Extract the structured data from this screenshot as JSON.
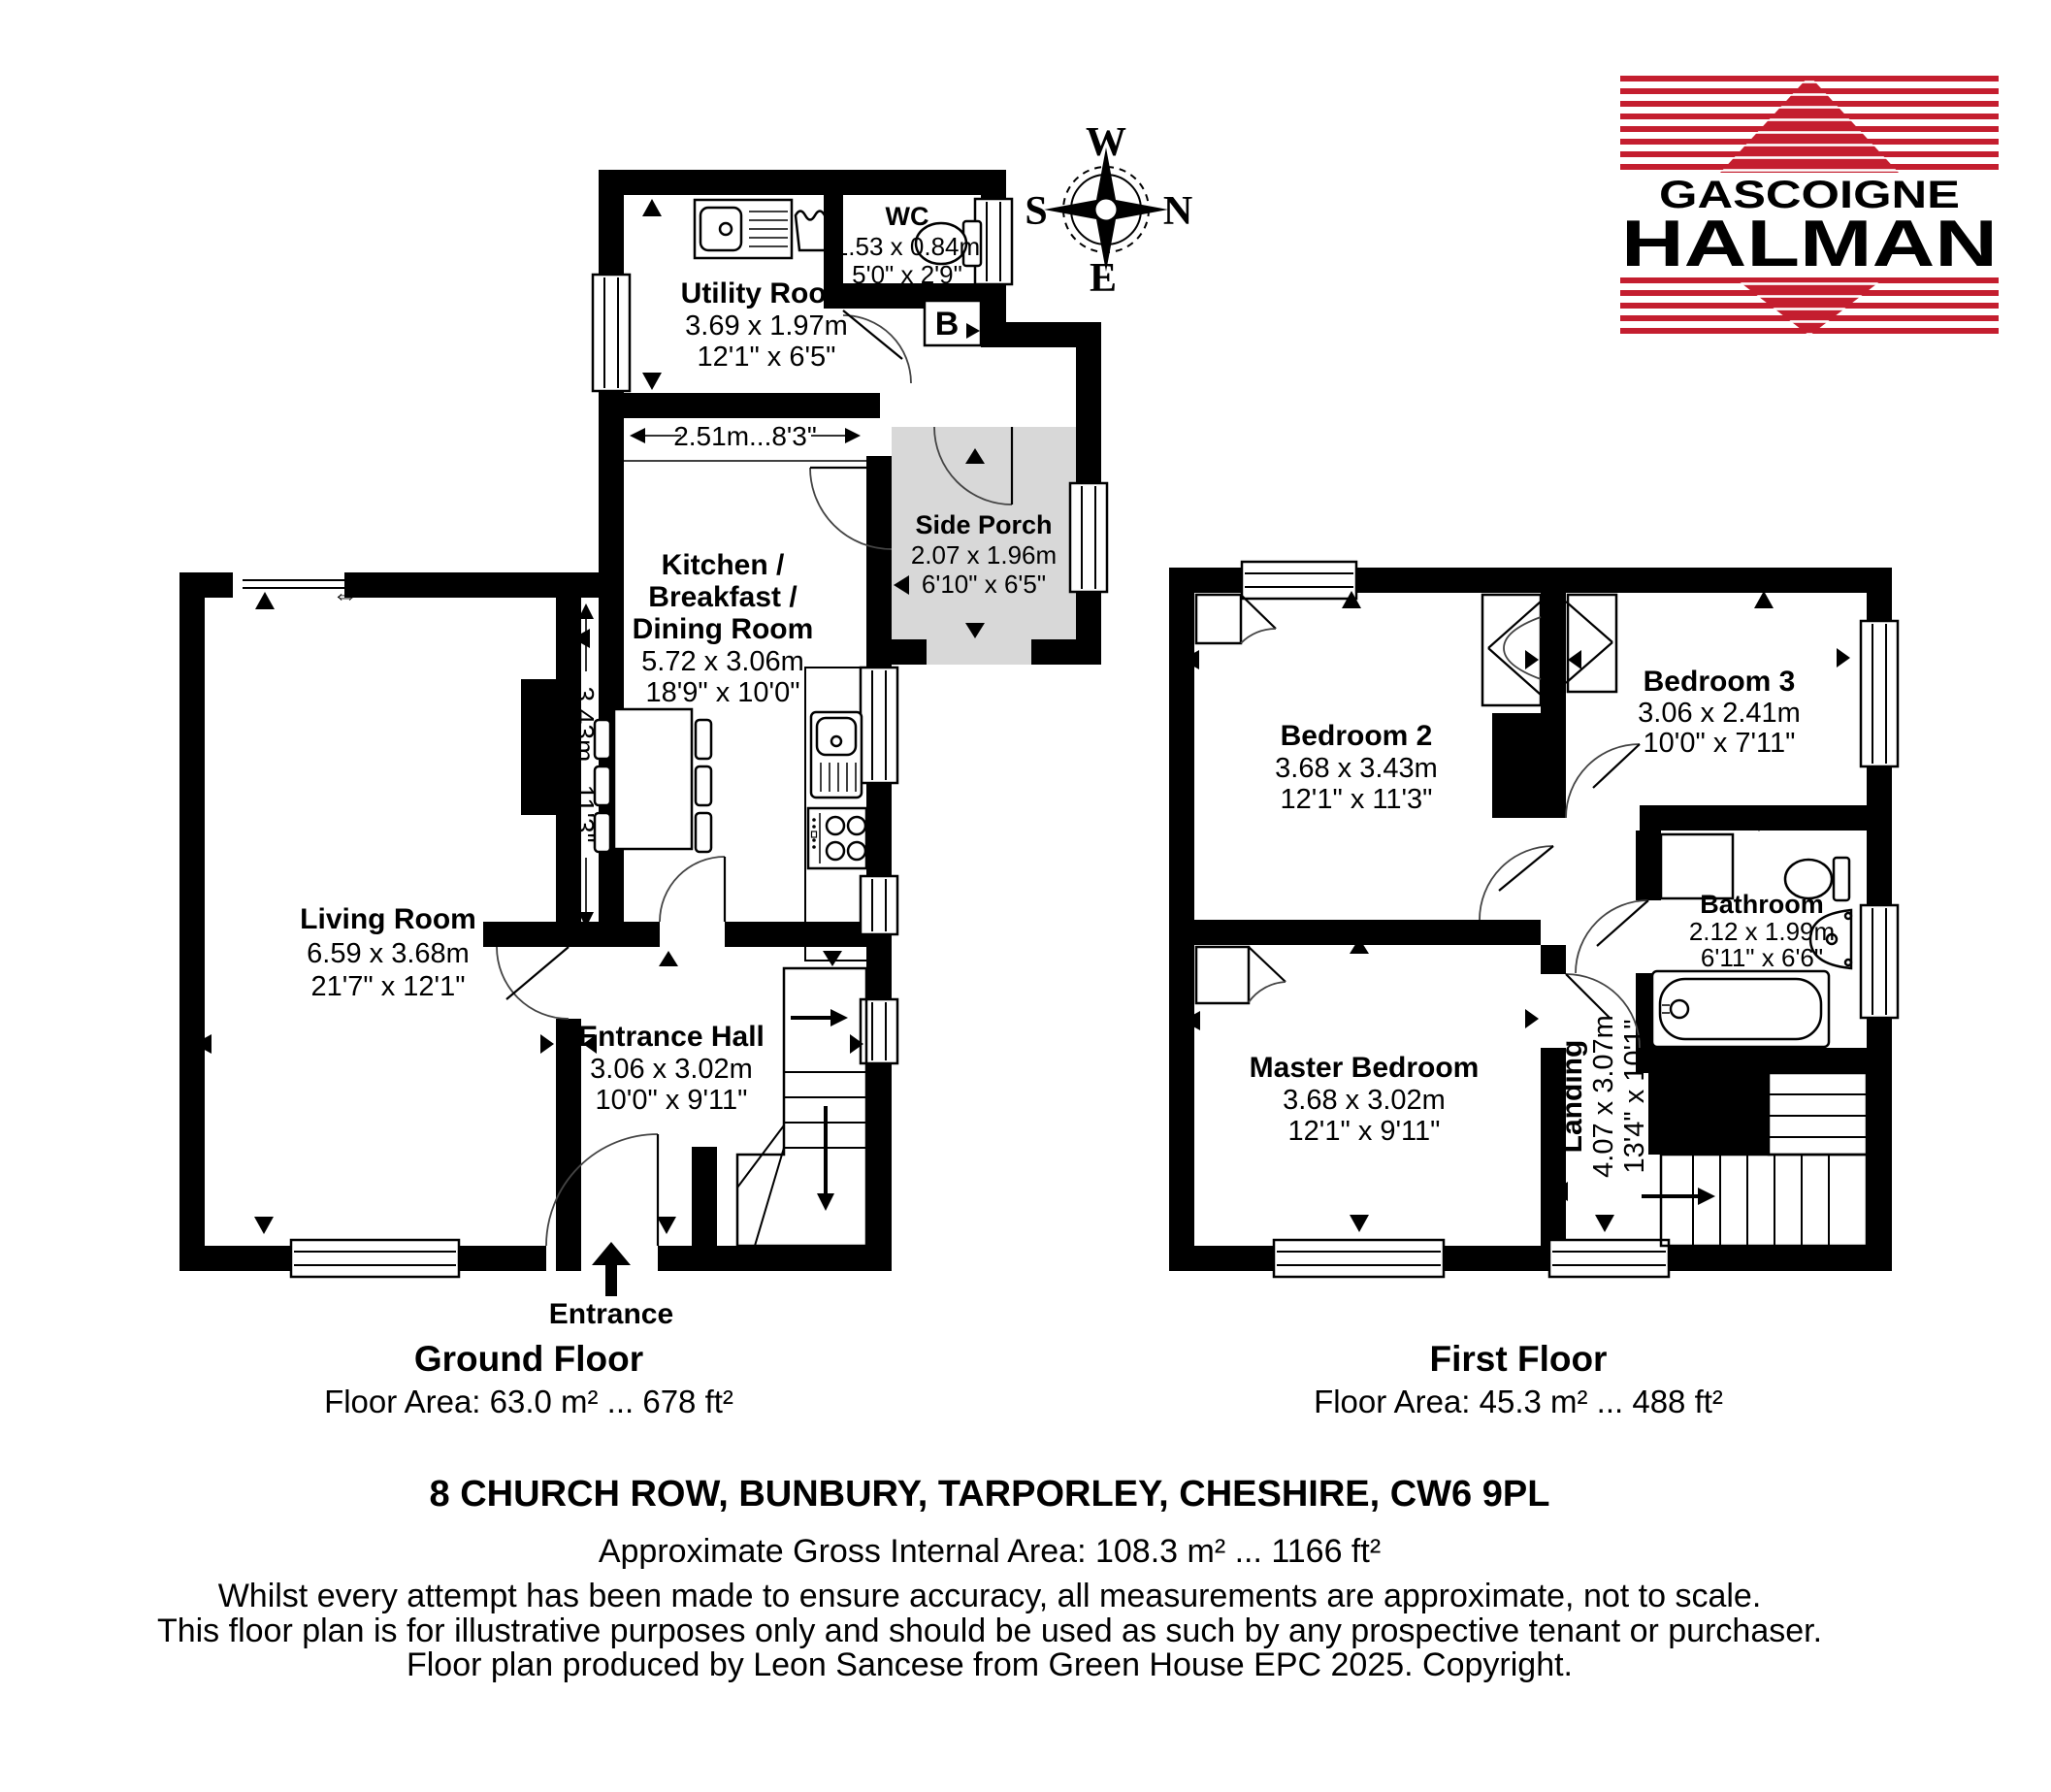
{
  "colors": {
    "brand_red": "#c41e2f",
    "porch_gray": "#d8d8d8"
  },
  "logo": {
    "top": "GASCOIGNE",
    "bottom": "HALMAN"
  },
  "compass": {
    "west": "W",
    "south": "S",
    "north": "N",
    "east": "E"
  },
  "ground_floor": {
    "caption_title": "Ground Floor",
    "caption_area": "Floor Area: 63.0 m² ... 678 ft²",
    "entrance_label": "Entrance",
    "boiler_label": "B",
    "opening_symbol": "⇔",
    "dim_horizontal": "2.51m...8'3\"",
    "dim_vertical": "3.43m...11'3\"",
    "rooms": {
      "utility": {
        "name": "Utility Room",
        "metric": "3.69 x 1.97m",
        "imperial": "12'1\" x 6'5\""
      },
      "wc": {
        "name": "WC",
        "metric": "1.53 x 0.84m",
        "imperial": "5'0\" x 2'9\""
      },
      "side_porch": {
        "name": "Side Porch",
        "metric": "2.07 x 1.96m",
        "imperial": "6'10\" x 6'5\""
      },
      "kitchen": {
        "name1": "Kitchen /",
        "name2": "Breakfast /",
        "name3": "Dining Room",
        "metric": "5.72 x 3.06m",
        "imperial": "18'9\" x 10'0\""
      },
      "living": {
        "name": "Living Room",
        "metric": "6.59 x 3.68m",
        "imperial": "21'7\" x 12'1\""
      },
      "hall": {
        "name": "Entrance Hall",
        "metric": "3.06 x 3.02m",
        "imperial": "10'0\" x 9'11\""
      }
    }
  },
  "first_floor": {
    "caption_title": "First Floor",
    "caption_area": "Floor Area: 45.3 m² ... 488 ft²",
    "rooms": {
      "bedroom2": {
        "name": "Bedroom 2",
        "metric": "3.68 x 3.43m",
        "imperial": "12'1\" x 11'3\""
      },
      "bedroom3": {
        "name": "Bedroom 3",
        "metric": "3.06 x 2.41m",
        "imperial": "10'0\" x 7'11\""
      },
      "bathroom": {
        "name": "Bathroom",
        "metric": "2.12 x 1.99m",
        "imperial": "6'11\" x 6'6\""
      },
      "master": {
        "name": "Master Bedroom",
        "metric": "3.68 x 3.02m",
        "imperial": "12'1\" x 9'11\""
      },
      "landing": {
        "name": "Landing",
        "metric": "4.07 x 3.07m",
        "imperial": "13'4\" x 10'1\""
      }
    }
  },
  "footer": {
    "address": "8 CHURCH ROW, BUNBURY, TARPORLEY, CHESHIRE, CW6 9PL",
    "area_line": "Approximate Gross Internal Area: 108.3 m² ... 1166 ft²",
    "disclaimer1": "Whilst every attempt has been made to ensure accuracy, all measurements are approximate, not to scale.",
    "disclaimer2": "This floor plan is for illustrative purposes only and should be used as such by any prospective tenant or purchaser.",
    "credit": "Floor plan produced by Leon Sancese from Green House EPC 2025. Copyright."
  }
}
